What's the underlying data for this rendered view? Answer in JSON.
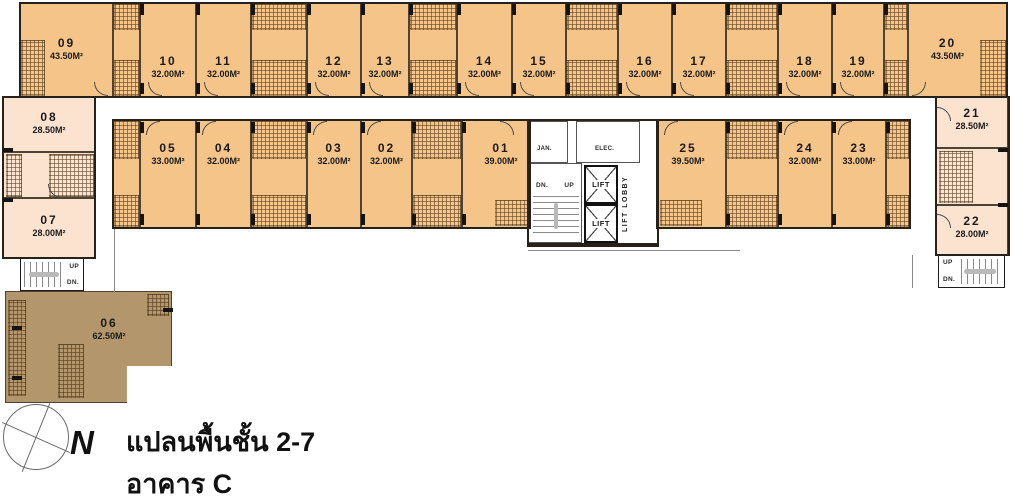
{
  "caption": {
    "line1": "แปลนพื้นชั้น 2-7",
    "line2": "อาคาร C",
    "north": "N"
  },
  "colors": {
    "unit_orange": "#F5C489",
    "unit_light": "#FBE3D0",
    "unit_brown": "#B3966B",
    "wall": "#26211a"
  },
  "core": {
    "jan": "JAN.",
    "elec": "ELEC.",
    "lift1": "LIFT",
    "lift2": "LIFT",
    "lobby": "LIFT LOBBY",
    "dn": "DN.",
    "up": "UP"
  },
  "stairs_left": {
    "up": "UP",
    "dn": "DN."
  },
  "stairs_right": {
    "up": "UP",
    "dn": "DN."
  },
  "units": {
    "u01": {
      "no": "01",
      "area": "39.00M²"
    },
    "u02": {
      "no": "02",
      "area": "32.00M²"
    },
    "u03": {
      "no": "03",
      "area": "32.00M²"
    },
    "u04": {
      "no": "04",
      "area": "32.00M²"
    },
    "u05": {
      "no": "05",
      "area": "33.00M²"
    },
    "u06": {
      "no": "06",
      "area": "62.50M²"
    },
    "u07": {
      "no": "07",
      "area": "28.00M²"
    },
    "u08": {
      "no": "08",
      "area": "28.50M²"
    },
    "u09": {
      "no": "09",
      "area": "43.50M²"
    },
    "u10": {
      "no": "10",
      "area": "32.00M²"
    },
    "u11": {
      "no": "11",
      "area": "32.00M²"
    },
    "u12": {
      "no": "12",
      "area": "32.00M²"
    },
    "u13": {
      "no": "13",
      "area": "32.00M²"
    },
    "u14": {
      "no": "14",
      "area": "32.00M²"
    },
    "u15": {
      "no": "15",
      "area": "32.00M²"
    },
    "u16": {
      "no": "16",
      "area": "32.00M²"
    },
    "u17": {
      "no": "17",
      "area": "32.00M²"
    },
    "u18": {
      "no": "18",
      "area": "32.00M²"
    },
    "u19": {
      "no": "19",
      "area": "32.00M²"
    },
    "u20": {
      "no": "20",
      "area": "43.50M²"
    },
    "u21": {
      "no": "21",
      "area": "28.50M²"
    },
    "u22": {
      "no": "22",
      "area": "28.00M²"
    },
    "u23": {
      "no": "23",
      "area": "33.00M²"
    },
    "u24": {
      "no": "24",
      "area": "32.00M²"
    },
    "u25": {
      "no": "25",
      "area": "39.50M²"
    }
  }
}
